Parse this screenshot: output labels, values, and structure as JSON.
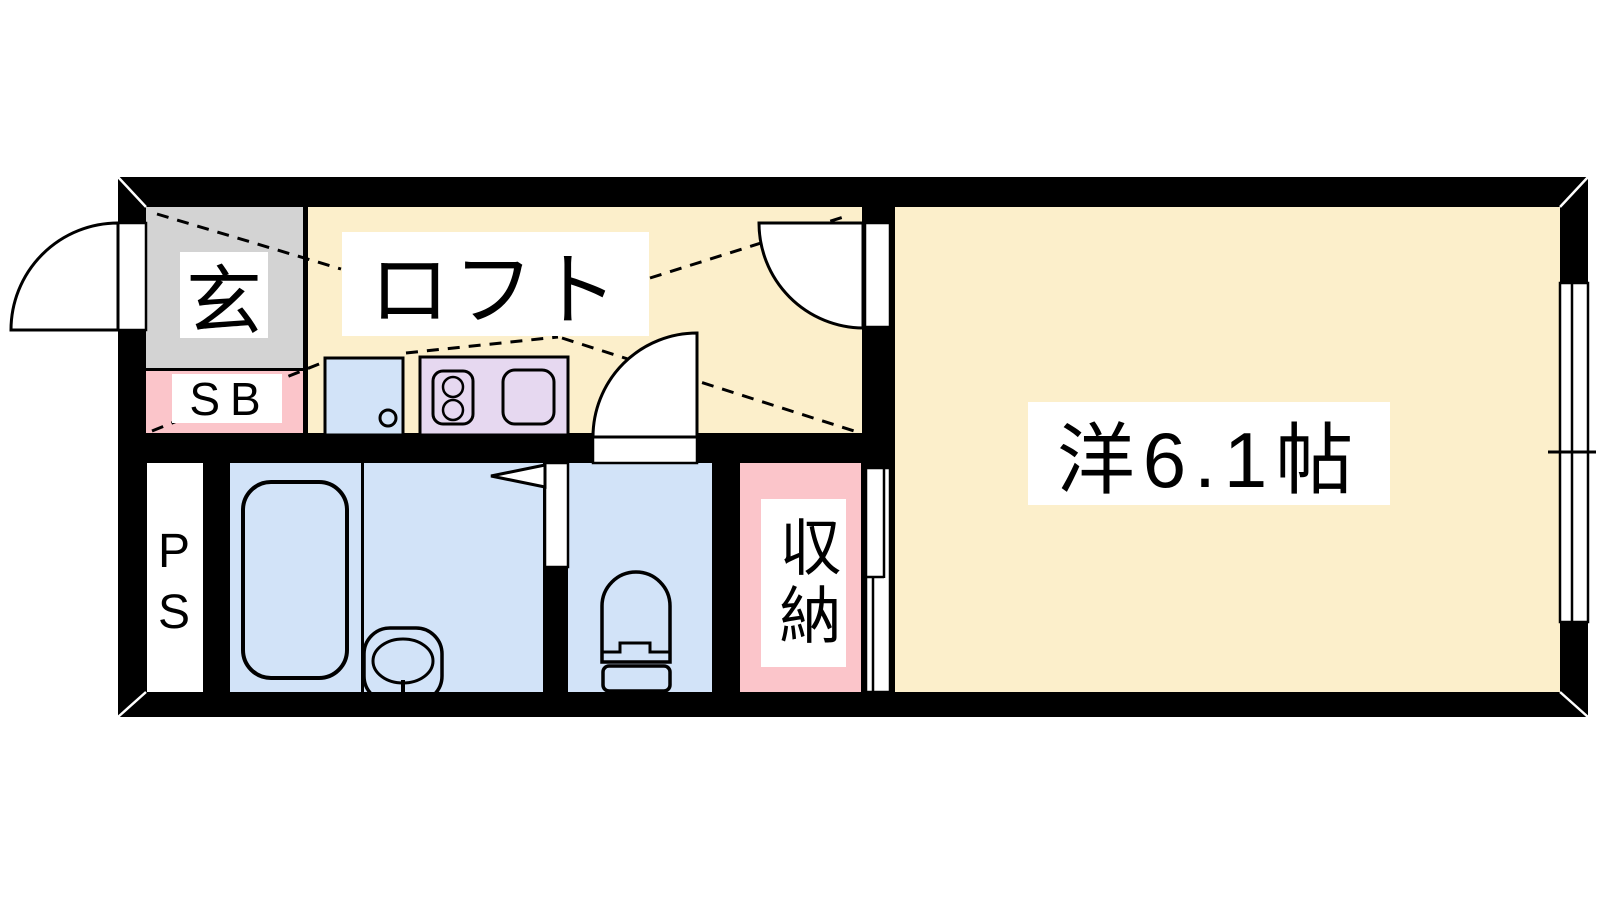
{
  "palette": {
    "wall": "#000000",
    "floor": "#FCEFCB",
    "genkan": "#D3D3D3",
    "pink": "#FBC5CA",
    "water": "#D2E3F8",
    "kitchen": "#E6D8F0",
    "paper": "#FFFFFF",
    "line": "#000000"
  },
  "rooms": {
    "genkan": {
      "label": "玄"
    },
    "shoe_box": {
      "label": "SB"
    },
    "loft": {
      "label": "ロフト"
    },
    "western_room": {
      "label": "洋6.1帖",
      "size_tatami": "6.1"
    },
    "storage": {
      "label": "収納"
    },
    "pipe_space": {
      "label": "PS"
    }
  }
}
